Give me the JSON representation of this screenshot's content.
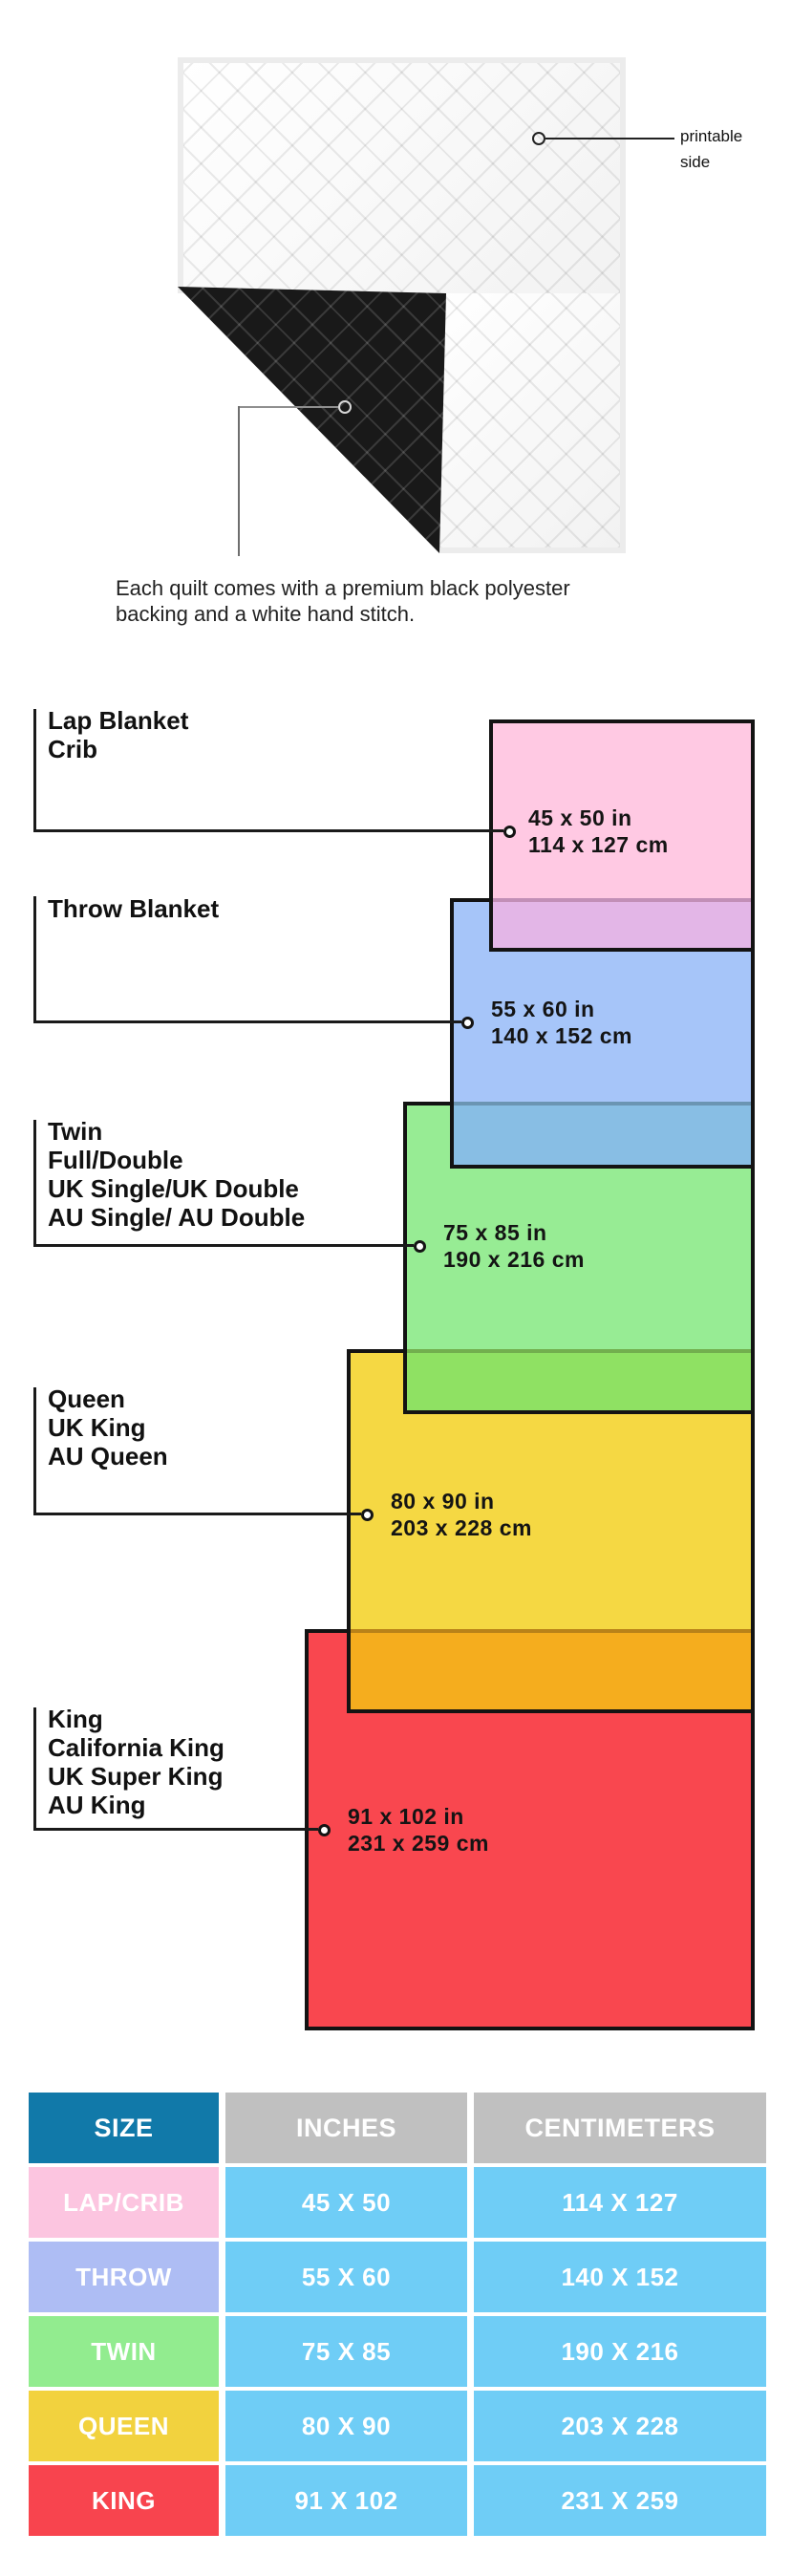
{
  "quilt": {
    "printable_label_lines": [
      "printable",
      "side"
    ],
    "caption_lines": [
      "Each quilt comes with a premium black polyester",
      "backing and a white hand stitch."
    ]
  },
  "diagram": {
    "sizes": [
      {
        "key": "lap",
        "label_lines": [
          "Lap Blanket",
          "Crib"
        ],
        "inches": "45 x 50 in",
        "centimeters": "114 x 127 cm",
        "fill": "#FFC9E3"
      },
      {
        "key": "throw",
        "label_lines": [
          "Throw Blanket"
        ],
        "inches": "55 x 60 in",
        "centimeters": "140 x 152 cm",
        "fill": "#A6C5F9"
      },
      {
        "key": "twin",
        "label_lines": [
          "Twin",
          "Full/Double",
          "UK Single/UK Double",
          "AU Single/ AU Double"
        ],
        "inches": "75 x 85 in",
        "centimeters": "190 x 216 cm",
        "fill": "#97EC94"
      },
      {
        "key": "queen",
        "label_lines": [
          "Queen",
          "UK King",
          "AU Queen"
        ],
        "inches": "80 x 90 in",
        "centimeters": "203 x 228 cm",
        "fill": "#F5D843"
      },
      {
        "key": "king",
        "label_lines": [
          "King",
          "California King",
          "UK Super King",
          "AU King"
        ],
        "inches": "91 x 102 in",
        "centimeters": "231 x 259 cm",
        "fill": "#F9474F"
      }
    ],
    "overlap_fills": {
      "pink_over_blue": "#E3B6E7",
      "blue_over_green": "#88BEE4",
      "green_over_yellow": "#8FE163",
      "yellow_over_red": "#F5AD1E"
    }
  },
  "table": {
    "headers": [
      "SIZE",
      "INCHES",
      "CENTIMETERS"
    ],
    "header_colors": {
      "size": "#1179A9",
      "measure": "#C0C0C0"
    },
    "value_cell_color": "#6FCDF6",
    "rows": [
      {
        "size": "LAP/CRIB",
        "inches": "45 X 50",
        "centimeters": "114 X 127",
        "color": "#FCC5E0"
      },
      {
        "size": "THROW",
        "inches": "55 X 60",
        "centimeters": "140 X 152",
        "color": "#AEBDF4"
      },
      {
        "size": "TWIN",
        "inches": "75 X 85",
        "centimeters": "190 X 216",
        "color": "#92EC8F"
      },
      {
        "size": "QUEEN",
        "inches": "80 X 90",
        "centimeters": "203 X 228",
        "color": "#F2D23E"
      },
      {
        "size": "KING",
        "inches": "91 X 102",
        "centimeters": "231 X 259",
        "color": "#F8444E"
      }
    ]
  }
}
